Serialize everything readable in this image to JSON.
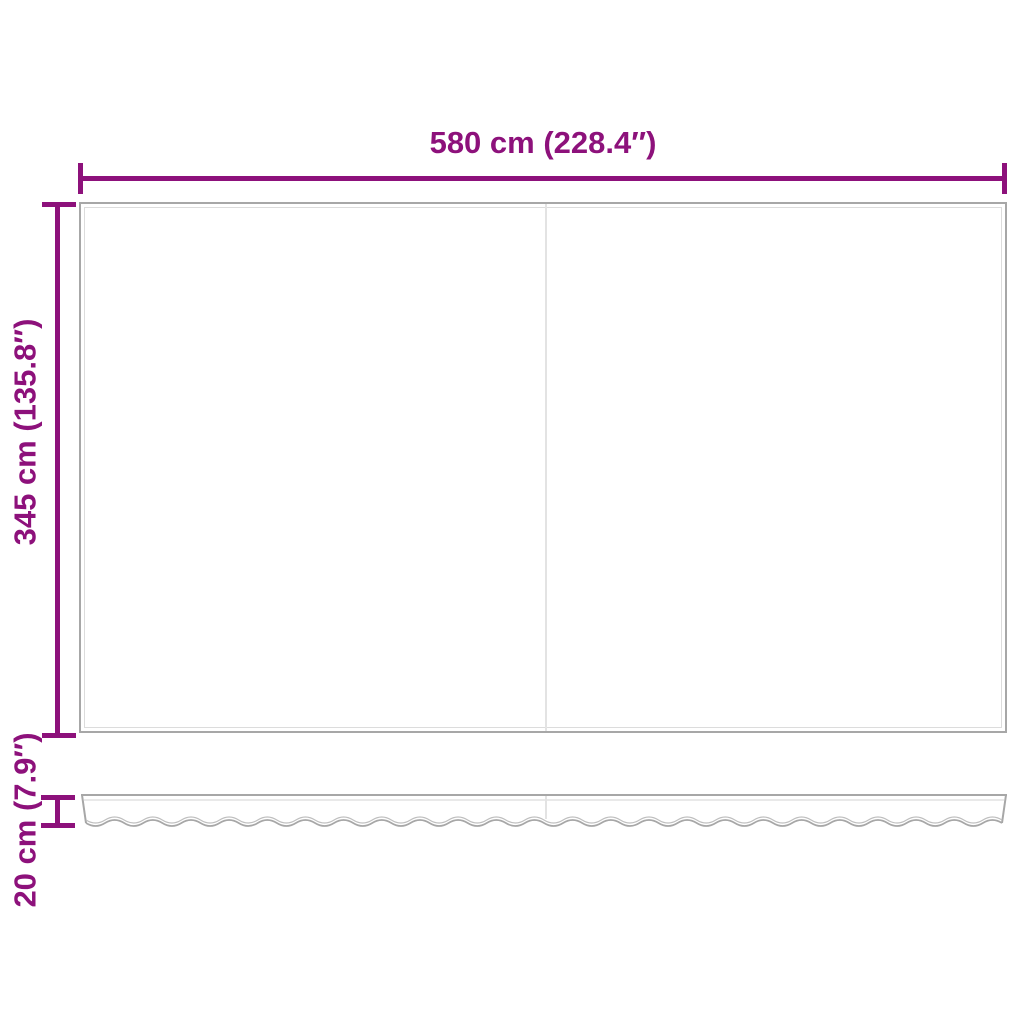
{
  "labels": {
    "width": "580 cm (228.4″)",
    "height": "345 cm (135.8″)",
    "valance_height": "20 cm (7.9″)"
  },
  "colors": {
    "dimension": "#8d117b",
    "fabric_border": "#a7a7a7",
    "fabric_inner_line": "#dcdcdc",
    "panel_divider": "#e3e3e3",
    "wave_inner": "#bfbfbf",
    "background": "#ffffff"
  }
}
